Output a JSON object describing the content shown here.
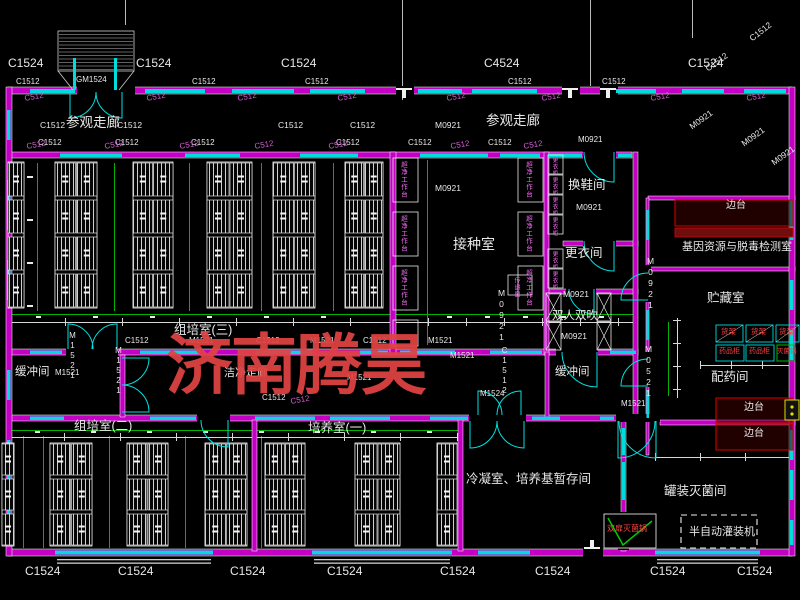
{
  "watermark": {
    "text": "济南腾昊",
    "color": "#e04343"
  },
  "colors": {
    "background": "#000000",
    "wall_magenta": "#c400c4",
    "window_cyan": "#00dcdc",
    "door_cyan": "#00e0e0",
    "line_white": "#e8e8e8",
    "dim_green": "#00b400",
    "equip_red_box": "#e00000",
    "dim_text_magenta": "#d95fd9",
    "equip_text_red": "#ff4242",
    "bench_text_pink": "#ff6bff",
    "watermark_red": "#e04343"
  },
  "room_labels": [
    {
      "n": "room-visit-corridor-left",
      "t": "参观走廊",
      "x": 66,
      "y": 116,
      "s": 13.5
    },
    {
      "n": "room-visit-corridor-right",
      "t": "参观走廊",
      "x": 486,
      "y": 114,
      "s": 13.5
    },
    {
      "n": "room-tissue-culture-3",
      "t": "组培室(三)",
      "x": 174,
      "y": 324,
      "s": 12.5
    },
    {
      "n": "room-inoculation",
      "t": "接种室",
      "x": 453,
      "y": 237,
      "s": 14
    },
    {
      "n": "room-shoe-change",
      "t": "换鞋间",
      "x": 568,
      "y": 179,
      "s": 12.5
    },
    {
      "n": "room-clothes-change",
      "t": "更衣间",
      "x": 565,
      "y": 247,
      "s": 12.5
    },
    {
      "n": "room-air-shower",
      "t": "双人双吹",
      "x": 552,
      "y": 311,
      "s": 11.5
    },
    {
      "n": "room-buffer-right",
      "t": "缓冲间",
      "x": 555,
      "y": 367,
      "s": 11.5
    },
    {
      "n": "room-buffer-left",
      "t": "缓冲间",
      "x": 15,
      "y": 367,
      "s": 11.5
    },
    {
      "n": "room-tissue-culture-2",
      "t": "组培室(二)",
      "x": 74,
      "y": 420,
      "s": 12.5
    },
    {
      "n": "room-culture-1",
      "t": "培养室(一)",
      "x": 308,
      "y": 422,
      "s": 12.5
    },
    {
      "n": "room-condensation-storage",
      "t": "冷凝室、培养基暂存间",
      "x": 466,
      "y": 473,
      "s": 12.5
    },
    {
      "n": "room-gene-resource-lab",
      "t": "基因资源与脱毒检测室",
      "x": 682,
      "y": 242,
      "s": 11
    },
    {
      "n": "room-storage",
      "t": "贮藏室",
      "x": 707,
      "y": 292,
      "s": 12.5
    },
    {
      "n": "room-dispensary",
      "t": "配药间",
      "x": 711,
      "y": 371,
      "s": 12.5
    },
    {
      "n": "room-canning-sterilization",
      "t": "罐装灭菌间",
      "x": 664,
      "y": 485,
      "s": 12.5
    },
    {
      "n": "room-clean-corridor",
      "t": "洁净走廊",
      "x": 224,
      "y": 368,
      "s": 11
    }
  ],
  "equipment_labels": [
    {
      "n": "side-bench-1",
      "t": "边台",
      "x": 726,
      "y": 201,
      "s": 10
    },
    {
      "n": "side-bench-2",
      "t": "边台",
      "x": 744,
      "y": 403,
      "s": 10
    },
    {
      "n": "side-bench-3",
      "t": "边台",
      "x": 744,
      "y": 429,
      "s": 10
    },
    {
      "n": "shelf-1",
      "t": "货架",
      "x": 721,
      "y": 328,
      "s": 7.5,
      "c": "red"
    },
    {
      "n": "shelf-2",
      "t": "货架",
      "x": 751,
      "y": 328,
      "s": 7.5,
      "c": "red"
    },
    {
      "n": "shelf-3",
      "t": "货架",
      "x": 779,
      "y": 328,
      "s": 7.5,
      "c": "red"
    },
    {
      "n": "medicine-cabinet-1",
      "t": "药品柜",
      "x": 719,
      "y": 348,
      "s": 7,
      "c": "red"
    },
    {
      "n": "medicine-cabinet-2",
      "t": "药品柜",
      "x": 749,
      "y": 348,
      "s": 7,
      "c": "red"
    },
    {
      "n": "sterilizer-pot",
      "t": "灭菌锅",
      "x": 777,
      "y": 349,
      "s": 6.5,
      "c": "red"
    },
    {
      "n": "double-door-sterilizer",
      "t": "双扉灭菌锅",
      "x": 607,
      "y": 525,
      "s": 8,
      "c": "red"
    },
    {
      "n": "semi-auto-filler",
      "t": "半自动灌装机",
      "x": 689,
      "y": 527,
      "s": 11
    },
    {
      "n": "clean-bench-l1",
      "t": "超净工作台",
      "x": 399,
      "y": 161,
      "s": 6.5,
      "c": "pink",
      "v": 1
    },
    {
      "n": "clean-bench-l2",
      "t": "超净工作台",
      "x": 399,
      "y": 215,
      "s": 6.5,
      "c": "pink",
      "v": 1
    },
    {
      "n": "clean-bench-l3",
      "t": "超净工作台",
      "x": 399,
      "y": 269,
      "s": 6.5,
      "c": "pink",
      "v": 1
    },
    {
      "n": "clean-bench-r1",
      "t": "超净工作台",
      "x": 524,
      "y": 161,
      "s": 6.5,
      "c": "pink",
      "v": 1
    },
    {
      "n": "clean-bench-r2",
      "t": "超净工作台",
      "x": 524,
      "y": 215,
      "s": 6.5,
      "c": "pink",
      "v": 1
    },
    {
      "n": "clean-bench-r3",
      "t": "超净工作台",
      "x": 524,
      "y": 269,
      "s": 6.5,
      "c": "pink",
      "v": 1
    },
    {
      "n": "locker-1",
      "t": "更衣柜",
      "x": 551,
      "y": 157,
      "s": 5.5,
      "c": "pink",
      "v": 1
    },
    {
      "n": "locker-2",
      "t": "更衣柜",
      "x": 551,
      "y": 177,
      "s": 5.5,
      "c": "pink",
      "v": 1
    },
    {
      "n": "locker-3",
      "t": "更衣柜",
      "x": 551,
      "y": 197,
      "s": 5.5,
      "c": "pink",
      "v": 1
    },
    {
      "n": "locker-4",
      "t": "更衣柜",
      "x": 551,
      "y": 217,
      "s": 5.5,
      "c": "pink",
      "v": 1
    },
    {
      "n": "locker-5",
      "t": "更衣柜",
      "x": 551,
      "y": 251,
      "s": 5.5,
      "c": "pink",
      "v": 1
    },
    {
      "n": "locker-6",
      "t": "更衣柜",
      "x": 551,
      "y": 271,
      "s": 5.5,
      "c": "pink",
      "v": 1
    },
    {
      "n": "pass-box",
      "t": "传递窗",
      "x": 513,
      "y": 277,
      "s": 6,
      "c": "pink",
      "v": 1
    }
  ],
  "dimension_labels": [
    {
      "n": "c1524-top-1",
      "t": "C1524",
      "x": 8,
      "y": 57,
      "s": 12
    },
    {
      "n": "c1524-top-2",
      "t": "C1524",
      "x": 136,
      "y": 57,
      "s": 12
    },
    {
      "n": "c1524-top-3",
      "t": "C1524",
      "x": 281,
      "y": 57,
      "s": 12
    },
    {
      "n": "c4524-top",
      "t": "C4524",
      "x": 484,
      "y": 57,
      "s": 12
    },
    {
      "n": "c1524-top-4",
      "t": "C1524",
      "x": 688,
      "y": 57,
      "s": 12
    },
    {
      "n": "c1512-diag-1",
      "t": "C1512",
      "x": 748,
      "y": 36,
      "s": 8.5,
      "r": -38
    },
    {
      "n": "c1512-diag-2",
      "t": "C1512",
      "x": 704,
      "y": 66,
      "s": 8.5,
      "r": -36
    },
    {
      "n": "gm1524",
      "t": "GM1524",
      "x": 76,
      "y": 76,
      "s": 8
    },
    {
      "n": "c1512-top-1",
      "t": "C1512",
      "x": 16,
      "y": 78,
      "s": 8
    },
    {
      "n": "c1512-top-2",
      "t": "C1512",
      "x": 192,
      "y": 78,
      "s": 8
    },
    {
      "n": "c1512-top-3",
      "t": "C1512",
      "x": 305,
      "y": 78,
      "s": 8
    },
    {
      "n": "c1512-top-4",
      "t": "C1512",
      "x": 508,
      "y": 78,
      "s": 8
    },
    {
      "n": "c1512-top-5",
      "t": "C1512",
      "x": 602,
      "y": 78,
      "s": 8
    },
    {
      "n": "c512-top-1",
      "t": "C512",
      "x": 24,
      "y": 95,
      "s": 8,
      "c": "mag",
      "r": -10
    },
    {
      "n": "c512-top-2",
      "t": "C512",
      "x": 146,
      "y": 95,
      "s": 8,
      "c": "mag",
      "r": -10
    },
    {
      "n": "c512-top-3",
      "t": "C512",
      "x": 237,
      "y": 95,
      "s": 8,
      "c": "mag",
      "r": -10
    },
    {
      "n": "c512-top-4",
      "t": "C512",
      "x": 337,
      "y": 95,
      "s": 8,
      "c": "mag",
      "r": -10
    },
    {
      "n": "c512-top-5",
      "t": "C512",
      "x": 446,
      "y": 95,
      "s": 8,
      "c": "mag",
      "r": -10
    },
    {
      "n": "c512-top-6",
      "t": "C512",
      "x": 541,
      "y": 95,
      "s": 8,
      "c": "mag",
      "r": -10
    },
    {
      "n": "c512-top-7",
      "t": "C512",
      "x": 650,
      "y": 95,
      "s": 8,
      "c": "mag",
      "r": -10
    },
    {
      "n": "c512-top-8",
      "t": "C512",
      "x": 746,
      "y": 95,
      "s": 8,
      "c": "mag",
      "r": -10
    },
    {
      "n": "c1512-cor-1",
      "t": "C1512",
      "x": 40,
      "y": 121,
      "s": 8.5
    },
    {
      "n": "c1512-cor-2",
      "t": "C1512",
      "x": 117,
      "y": 121,
      "s": 8.5
    },
    {
      "n": "c1512-cor-3",
      "t": "C1512",
      "x": 278,
      "y": 121,
      "s": 8.5
    },
    {
      "n": "c1512-cor-4",
      "t": "C1512",
      "x": 350,
      "y": 121,
      "s": 8.5
    },
    {
      "n": "m0921-cor",
      "t": "M0921",
      "x": 435,
      "y": 121,
      "s": 8.5
    },
    {
      "n": "m0921-diag-1",
      "t": "M0921",
      "x": 688,
      "y": 124,
      "s": 8.5,
      "r": -36
    },
    {
      "n": "m0921-diag-2",
      "t": "M0921",
      "x": 740,
      "y": 141,
      "s": 8.5,
      "r": -36
    },
    {
      "n": "m0921-diag-3",
      "t": "M0921",
      "x": 770,
      "y": 160,
      "s": 8.5,
      "r": -36
    },
    {
      "n": "c1512-w2-1",
      "t": "C1512",
      "x": 38,
      "y": 139,
      "s": 8
    },
    {
      "n": "c1512-w2-2",
      "t": "C1512",
      "x": 115,
      "y": 139,
      "s": 8
    },
    {
      "n": "c1512-w2-3",
      "t": "C1512",
      "x": 191,
      "y": 139,
      "s": 8
    },
    {
      "n": "c1512-w2-4",
      "t": "C1512",
      "x": 336,
      "y": 139,
      "s": 8
    },
    {
      "n": "c1512-w2-5",
      "t": "C1512",
      "x": 408,
      "y": 139,
      "s": 8
    },
    {
      "n": "c1512-w2-6",
      "t": "C1512",
      "x": 488,
      "y": 139,
      "s": 8
    },
    {
      "n": "m0921-w2",
      "t": "M0921",
      "x": 578,
      "y": 136,
      "s": 8
    },
    {
      "n": "c512-w2-1",
      "t": "C512",
      "x": 26,
      "y": 143,
      "s": 8,
      "c": "mag",
      "r": -10
    },
    {
      "n": "c512-w2-2",
      "t": "C512",
      "x": 104,
      "y": 143,
      "s": 8,
      "c": "mag",
      "r": -10
    },
    {
      "n": "c512-w2-3",
      "t": "C512",
      "x": 179,
      "y": 143,
      "s": 8,
      "c": "mag",
      "r": -10
    },
    {
      "n": "c512-w2-4",
      "t": "C512",
      "x": 254,
      "y": 143,
      "s": 8,
      "c": "mag",
      "r": -10
    },
    {
      "n": "c512-w2-5",
      "t": "C512",
      "x": 328,
      "y": 143,
      "s": 8,
      "c": "mag",
      "r": -10
    },
    {
      "n": "c512-w2-6",
      "t": "C512",
      "x": 450,
      "y": 143,
      "s": 8,
      "c": "mag",
      "r": -10
    },
    {
      "n": "c512-w2-7",
      "t": "C512",
      "x": 523,
      "y": 143,
      "s": 8,
      "c": "mag",
      "r": -10
    },
    {
      "n": "m0921-inoc",
      "t": "M0921",
      "x": 435,
      "y": 184,
      "s": 8.5
    },
    {
      "n": "m0921-shoe",
      "t": "M0921",
      "x": 576,
      "y": 203,
      "s": 8.5
    },
    {
      "n": "m0921-change",
      "t": "M0921",
      "x": 563,
      "y": 290,
      "s": 8.5
    },
    {
      "n": "m0921-shower",
      "t": "M0921",
      "x": 561,
      "y": 332,
      "s": 8.5
    },
    {
      "n": "m0921-v1",
      "t": "M0921",
      "x": 497,
      "y": 288,
      "s": 8.5,
      "v": 1
    },
    {
      "n": "m0921-v2",
      "t": "M0921",
      "x": 646,
      "y": 256,
      "s": 8.5,
      "v": 1
    },
    {
      "n": "m0521-v",
      "t": "M0521",
      "x": 644,
      "y": 344,
      "s": 8.5,
      "v": 1
    },
    {
      "n": "m1521-buf",
      "t": "M1521",
      "x": 55,
      "y": 369,
      "s": 8
    },
    {
      "n": "m1521-v1",
      "t": "M1521",
      "x": 68,
      "y": 331,
      "s": 8,
      "v": 1
    },
    {
      "n": "m1521-v2",
      "t": "M1521",
      "x": 114,
      "y": 346,
      "s": 8,
      "v": 1
    },
    {
      "n": "c1512-mid-1",
      "t": "C1512",
      "x": 125,
      "y": 337,
      "s": 8
    },
    {
      "n": "m1521-mid-1",
      "t": "M1521",
      "x": 189,
      "y": 337,
      "s": 8
    },
    {
      "n": "c1512-mid-2",
      "t": "C1512",
      "x": 256,
      "y": 337,
      "s": 8
    },
    {
      "n": "m1521-mid-2",
      "t": "M1521",
      "x": 310,
      "y": 337,
      "s": 8
    },
    {
      "n": "c1512-mid-3",
      "t": "C1512",
      "x": 363,
      "y": 337,
      "s": 8
    },
    {
      "n": "m1521-mid-3",
      "t": "M1521",
      "x": 428,
      "y": 337,
      "s": 8
    },
    {
      "n": "m1521-mid-4",
      "t": "M1521",
      "x": 450,
      "y": 352,
      "s": 8
    },
    {
      "n": "c1512-v",
      "t": "C1512",
      "x": 500,
      "y": 346,
      "s": 8,
      "v": 1
    },
    {
      "n": "m1524-door",
      "t": "M1524",
      "x": 480,
      "y": 390,
      "s": 8
    },
    {
      "n": "m1521-right",
      "t": "M1521",
      "x": 621,
      "y": 400,
      "s": 8
    },
    {
      "n": "c1512-mid-4",
      "t": "C1512",
      "x": 262,
      "y": 394,
      "s": 8
    },
    {
      "n": "c512-mid",
      "t": "C512",
      "x": 290,
      "y": 398,
      "s": 8,
      "c": "mag",
      "r": -10
    },
    {
      "n": "m1521-cor2",
      "t": "M1521",
      "x": 347,
      "y": 374,
      "s": 8
    },
    {
      "n": "c1524-bot-1",
      "t": "C1524",
      "x": 25,
      "y": 565,
      "s": 12
    },
    {
      "n": "c1524-bot-2",
      "t": "C1524",
      "x": 118,
      "y": 565,
      "s": 12
    },
    {
      "n": "c1524-bot-3",
      "t": "C1524",
      "x": 230,
      "y": 565,
      "s": 12
    },
    {
      "n": "c1524-bot-4",
      "t": "C1524",
      "x": 327,
      "y": 565,
      "s": 12
    },
    {
      "n": "c1524-bot-5",
      "t": "C1524",
      "x": 440,
      "y": 565,
      "s": 12
    },
    {
      "n": "c1524-bot-6",
      "t": "C1524",
      "x": 535,
      "y": 565,
      "s": 12
    },
    {
      "n": "c1524-bot-7",
      "t": "C1524",
      "x": 650,
      "y": 565,
      "s": 12
    },
    {
      "n": "c1524-bot-8",
      "t": "C1524",
      "x": 737,
      "y": 565,
      "s": 12
    }
  ]
}
